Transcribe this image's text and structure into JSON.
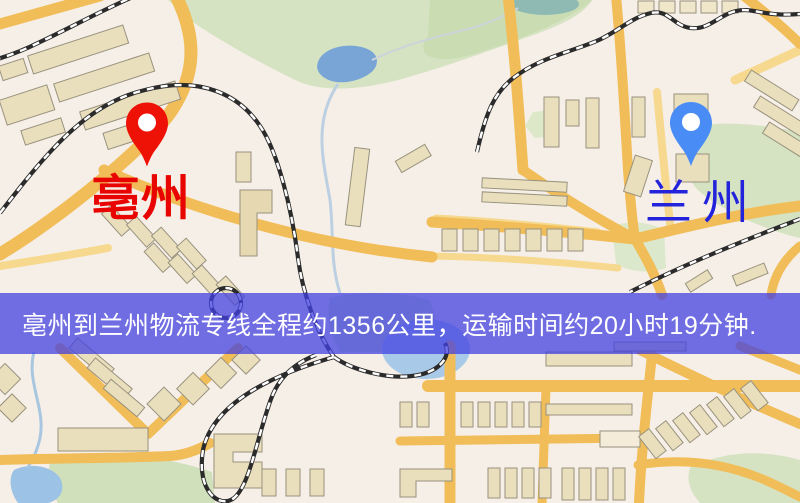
{
  "banner": {
    "text": "亳州到兰州物流专线全程约1356公里，运输时间约20小时19分钟.",
    "distance_text": "1356公里",
    "duration_text": "20小时19分钟"
  },
  "markers": {
    "origin": {
      "label": "亳州",
      "icon": "location-pin-icon"
    },
    "destination": {
      "label": "兰州",
      "icon": "location-pin-icon"
    }
  },
  "colors": {
    "origin_pin": "#ee1206",
    "origin_label": "#e80501",
    "destination_pin": "#4a8cf6",
    "destination_label": "#2323dc",
    "banner_bg": "rgba(67,65,226,0.75)",
    "banner_text": "#ffffff"
  }
}
